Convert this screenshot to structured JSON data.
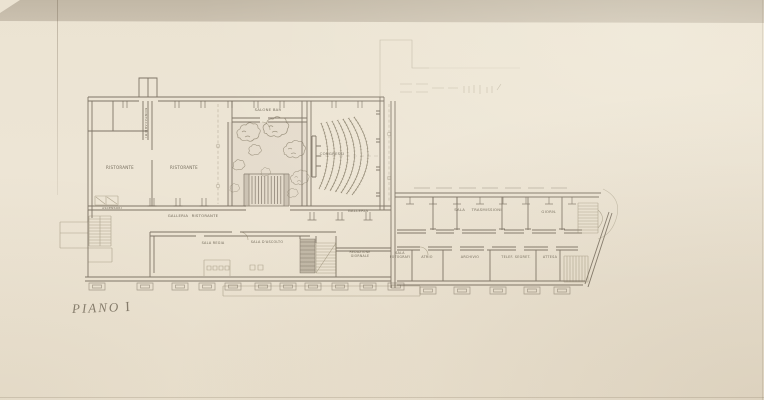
{
  "title": {
    "word": "PIANO",
    "numeral": "I"
  },
  "labels": {
    "ristorante_1": "RISTORANTE",
    "ristorante_2": "RISTORANTE",
    "montacarichi": "MONTACARICHI",
    "ascensori": "ASCENSORI",
    "salone_bar": "SALONE BAR",
    "congressi": "CONGRESSI",
    "galleria_ristorante": "GALLERIA RISTORANTE",
    "galleria": "GALLERIA",
    "sala_regia": "SALA REGIA",
    "sala_ascolto": "SALA D'ASCOLTO",
    "redazione_giornale": "REDAZIONE GIORNALE",
    "sala_fotografi": "SALA FOTOGRAFI",
    "sala_trasmissioni": "SALA TRASMISSIONI",
    "giorn": "GIORN.",
    "atrio": "ATRIO",
    "archivio": "ARCHIVIO",
    "telef_segret": "TELEF. SEGRET.",
    "attesa": "ATTESA"
  },
  "colors": {
    "paper": "#ece4d3",
    "scan_band": "#c6bcab",
    "pencil": "#6b6153",
    "label_text": "#665e4e"
  }
}
